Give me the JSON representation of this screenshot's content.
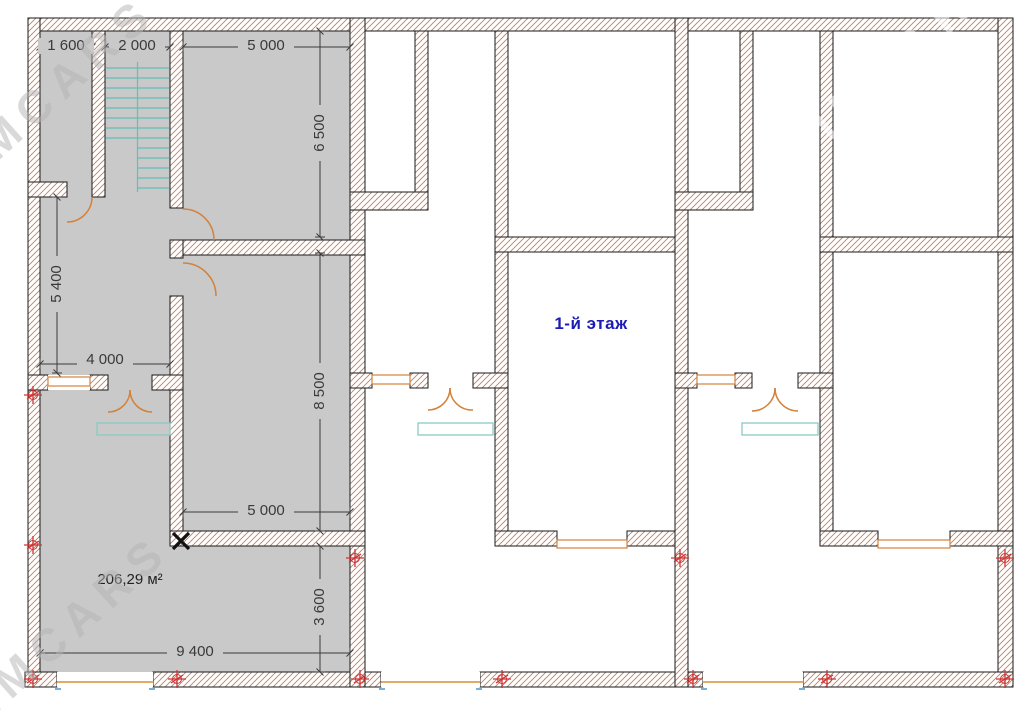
{
  "plan": {
    "floor_label": "1-й этаж",
    "area_label": "206,29 м²",
    "watermark_text": "IMCARS",
    "dimensions": {
      "top_left_room_width": "1 600",
      "stairwell_width": "2 000",
      "top_room_width": "5 000",
      "top_room_depth": "6 500",
      "corridor_depth": "5 400",
      "hall_width": "4 000",
      "middle_room_depth": "8 500",
      "middle_room_width": "5 000",
      "front_room_depth": "3 600",
      "front_room_width": "9 400"
    },
    "colors": {
      "wall_hatch": "#c0806a",
      "wall_outline": "#1a1a1a",
      "left_unit_floor": "#c9c9c9",
      "stairs": "#62bfb7",
      "doors_windows": "#d4813a",
      "window_sill": "#e2aa66",
      "floor_label_text": "#1b1bb5",
      "axis_marker": "#cc3333"
    }
  }
}
